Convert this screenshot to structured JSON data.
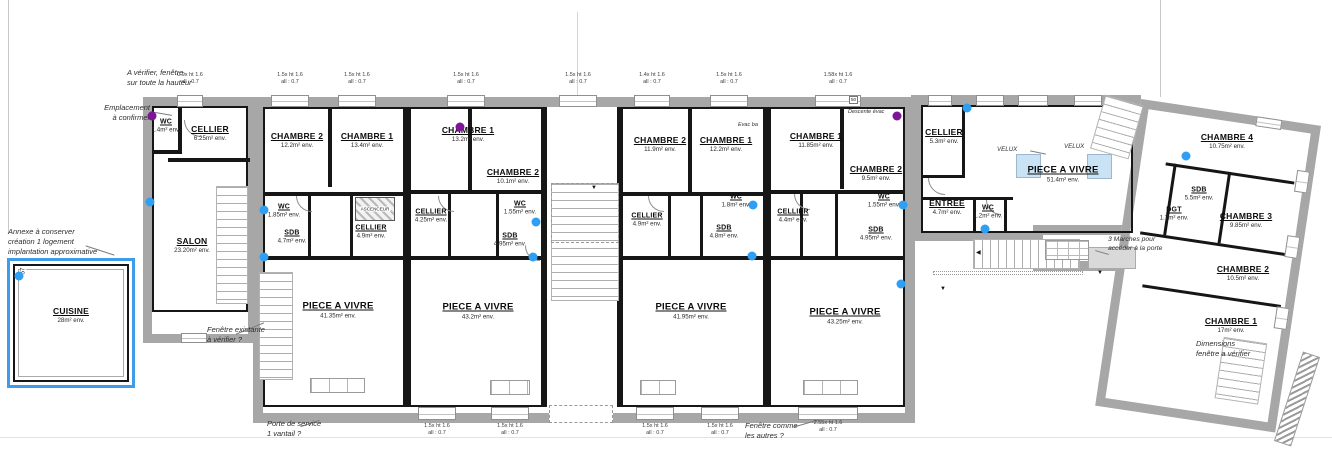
{
  "colors": {
    "wall_gray": "#a7a7a7",
    "wall_black": "#161616",
    "annex_highlight_blue": "#3f9ce8",
    "marker_blue": "#2e9ff2",
    "marker_purple": "#7d1696",
    "velux_blue": "#c9e2f4"
  },
  "icons": {
    "arrow_down": "▼",
    "arrow_left": "◀"
  },
  "rooms": {
    "annex_cuisine": {
      "name": "CUISINE",
      "area": "28m² env."
    },
    "a_wc": {
      "name": "WC",
      "area": "1.4m² env."
    },
    "a_cellier": {
      "name": "CELLIER",
      "area": "6.25m² env."
    },
    "a_salon": {
      "name": "SALON",
      "area": "23.20m² env."
    },
    "b_ch2": {
      "name": "CHAMBRE 2",
      "area": "12.2m² env."
    },
    "b_ch1": {
      "name": "CHAMBRE 1",
      "area": "13.4m² env."
    },
    "b_wc": {
      "name": "WC",
      "area": "1.85m² env."
    },
    "b_sdb": {
      "name": "SDB",
      "area": "4.7m² env."
    },
    "b_ascenseur": {
      "name": "ASCENCEUR"
    },
    "b_cellier": {
      "name": "CELLIER",
      "area": "4.9m² env."
    },
    "b_pav": {
      "name": "PIECE A VIVRE",
      "area": "41.35m² env."
    },
    "c_ch1": {
      "name": "CHAMBRE 1",
      "area": "13.2m² env."
    },
    "c_ch2": {
      "name": "CHAMBRE 2",
      "area": "10.1m² env."
    },
    "c_wc": {
      "name": "WC",
      "area": "1.55m² env."
    },
    "c_cellier": {
      "name": "CELLIER",
      "area": "4.25m² env."
    },
    "c_sdb": {
      "name": "SDB",
      "area": "4.95m² env."
    },
    "c_pav": {
      "name": "PIECE A VIVRE",
      "area": "43.2m² env."
    },
    "d_ch2": {
      "name": "CHAMBRE 2",
      "area": "11.9m² env."
    },
    "d_ch1": {
      "name": "CHAMBRE 1",
      "area": "12.2m² env."
    },
    "d_wc": {
      "name": "WC",
      "area": "1.8m² env."
    },
    "d_cellier": {
      "name": "CELLIER",
      "area": "4.9m² env."
    },
    "d_sdb": {
      "name": "SDB",
      "area": "4.8m² env."
    },
    "d_pav": {
      "name": "PIECE A VIVRE",
      "area": "41.95m² env."
    },
    "e_ch1": {
      "name": "CHAMBRE 1",
      "area": "11.85m² env."
    },
    "e_ch2": {
      "name": "CHAMBRE 2",
      "area": "9.5m² env."
    },
    "e_wc": {
      "name": "WC",
      "area": "1.55m² env."
    },
    "e_cellier": {
      "name": "CELLIER",
      "area": "4.4m² env."
    },
    "e_sdb": {
      "name": "SDB",
      "area": "4.95m² env."
    },
    "e_pav": {
      "name": "PIECE A VIVRE",
      "area": "43.25m² env."
    },
    "f_cellier": {
      "name": "CELLIER",
      "area": "5.3m² env."
    },
    "f_entree": {
      "name": "ENTREE",
      "area": "4.7m² env."
    },
    "f_wc": {
      "name": "WC",
      "area": "1.2m² env."
    },
    "f_pav": {
      "name": "PIECE A VIVRE",
      "area": "51.4m² env."
    },
    "g_ch4": {
      "name": "CHAMBRE 4",
      "area": "10.75m² env."
    },
    "g_sdb": {
      "name": "SDB",
      "area": "5.5m² env."
    },
    "g_dgt": {
      "name": "DGT",
      "area": "1.7m² env."
    },
    "g_ch3": {
      "name": "CHAMBRE 3",
      "area": "9.85m² env."
    },
    "g_ch2": {
      "name": "CHAMBRE 2",
      "area": "10.5m² env."
    },
    "g_ch1": {
      "name": "CHAMBRE 1",
      "area": "17m² env."
    }
  },
  "labels": {
    "velux": "VELUX"
  },
  "annotations": {
    "verify_window": "A vérifier, fenêtre\nsur toute la hauteur",
    "emplacement": "Emplacement\nà confirmer",
    "annexe": "Annexe à conserver\ncréation 1 logement\nimplantation approximative",
    "fenetre_existante": "Fenêtre existante\nà vérifier ?",
    "porte_service": "Porte de service\n1 vantail ?",
    "fenetre_comme": "Fenêtre comme\nles autres ?",
    "dimensions_fenetre": "Dimensions\nfenêtre a vérifier",
    "marches": "3 Marches pour\naccéder à la porte",
    "descente_evac": "Descente évac",
    "evac": "Evac ba"
  },
  "windows": {
    "top": [
      {
        "l1": "0.9x ht 1.6",
        "l2": "all : 0.7"
      },
      {
        "l1": "1.5x ht 1.6",
        "l2": "all : 0.7"
      },
      {
        "l1": "1.5x ht 1.6",
        "l2": "all : 0.7"
      },
      {
        "l1": "1.5x ht 1.6",
        "l2": "all : 0.7"
      },
      {
        "l1": "1.5x ht 1.6",
        "l2": "all : 0.7"
      },
      {
        "l1": "1.4x ht 1.6",
        "l2": "all : 0.7"
      },
      {
        "l1": "1.5x ht 1.6",
        "l2": "all : 0.7"
      },
      {
        "l1": "1.58x ht 1.6",
        "l2": "all : 0.7"
      }
    ],
    "bottom": [
      {
        "l1": "1.5x ht 1.6",
        "l2": "all : 0.7"
      },
      {
        "l1": "1.5x ht 1.6",
        "l2": "all : 0.7"
      },
      {
        "l1": "1.5x ht 1.6",
        "l2": "all : 0.7"
      },
      {
        "l1": "1.5x ht 1.6",
        "l2": "all : 0.7"
      },
      {
        "l1": "2.55x ht 1.6",
        "l2": "all : 0.7"
      }
    ]
  },
  "dims": {
    "d50": "50",
    "d57": "57"
  }
}
